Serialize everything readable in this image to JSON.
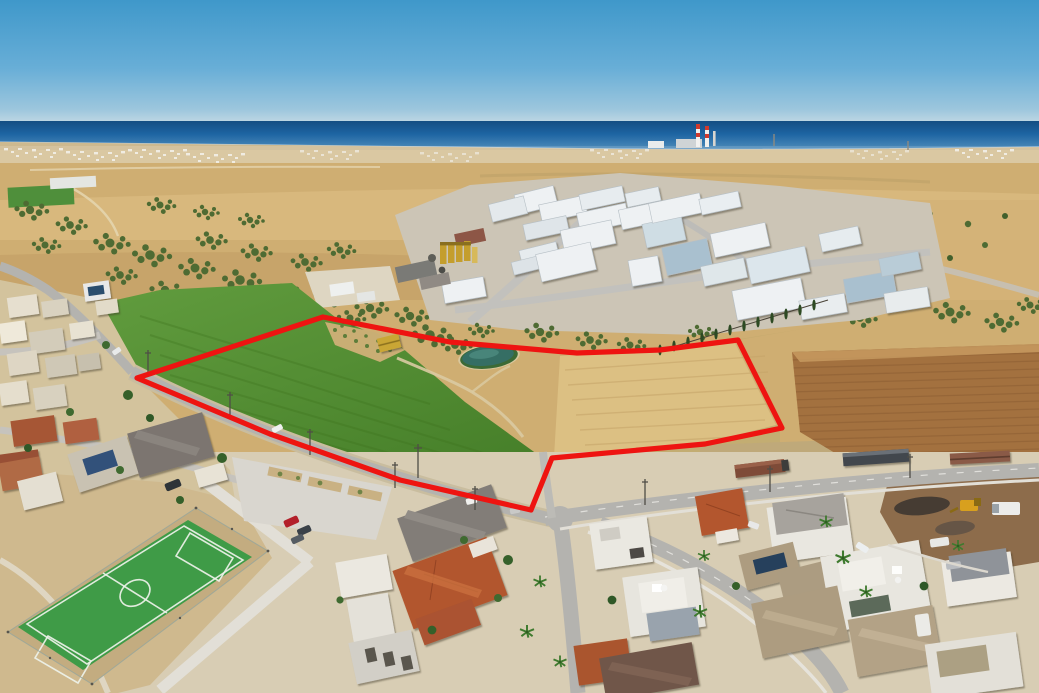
{
  "meta": {
    "type": "aerial-drone-photograph",
    "description": "Aerial view of a village edge on a coastal plain: a red boundary overlay marks a land plot of green cropland and harvested fields, beside an industrial estate, residential houses, a five-a-side football pitch and the sea on the horizon"
  },
  "annotation": {
    "boundary_points": "137,378 323,317 450,342 577,353 660,350 738,340 782,428 705,444 552,458 531,510 400,480 270,434",
    "boundary_stroke_width": "5.2"
  },
  "colors": {
    "boundary": "#ee1411",
    "sky_top": "#3f98ca",
    "sky_low": "#b7d4e2",
    "sea": "#1b5f9b",
    "shore_sand": "#cdb98f",
    "farmland": "#cfae72",
    "olive": "#4e6b33",
    "warehouse_white": "#eef1f3",
    "warehouse_blue": "#a9c0cf",
    "silo_yellow": "#c49e2d",
    "green_field": "#579034",
    "stubble_field": "#dcc083",
    "ploughed_field": "#a3713f",
    "pond": "#356e64",
    "road": "#b4b3af",
    "pitch_green": "#3f9b47",
    "pitch_line": "#eef2ea",
    "terracotta_roof": "#b2572f",
    "gray_roof": "#827d78",
    "khaki_roof": "#ad9c80",
    "white_wall": "#eae8e1",
    "dirt_yard": "#8d6c4b",
    "residential_ground": "#d8cdb4"
  },
  "scene": {
    "sky": "clear blue sky",
    "sea": "sea horizon band",
    "landmarks": [
      {
        "name": "power-station-chimneys"
      },
      {
        "name": "coastal-town"
      },
      {
        "name": "industrial-estate"
      },
      {
        "name": "concrete-plant-silos"
      },
      {
        "name": "plot-green-field"
      },
      {
        "name": "irrigation-pond"
      },
      {
        "name": "plot-stubble-field"
      },
      {
        "name": "ploughed-field"
      },
      {
        "name": "football-pitch"
      },
      {
        "name": "parking-lot"
      },
      {
        "name": "village-houses"
      },
      {
        "name": "machinery-yard"
      },
      {
        "name": "parked-trucks"
      },
      {
        "name": "plot-boundary-overlay"
      }
    ]
  }
}
